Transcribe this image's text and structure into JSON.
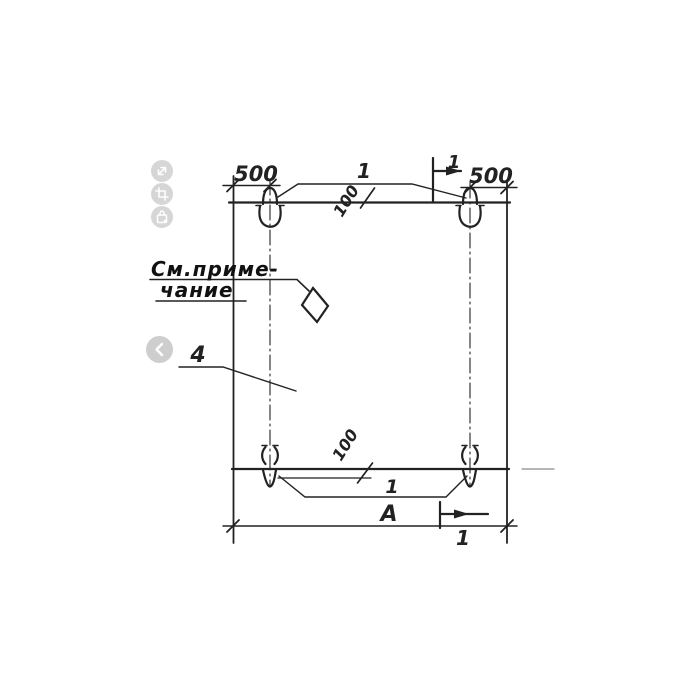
{
  "viewer": {
    "tools": [
      {
        "id": "expand",
        "icon": "expand-icon"
      },
      {
        "id": "crop",
        "icon": "crop-icon"
      },
      {
        "id": "bag",
        "icon": "bag-icon"
      }
    ],
    "nav_prev_icon": "chevron-left-icon"
  },
  "drawing": {
    "type": "technical-drawing",
    "labels": {
      "dim_top_left": "500",
      "dim_top_right": "500",
      "callout_loops_top": "1",
      "callout_loops_bottom": "1",
      "dim_offset_top": "100",
      "dim_offset_bottom": "100",
      "callout_panel": "4",
      "note_line1": "См.приме-",
      "note_line2": "чание",
      "dim_overall_width": "А",
      "section_mark_top": "1",
      "section_mark_bottom": "1"
    },
    "colors": {
      "ink": "#222222",
      "control_bg": "#c9c9c9",
      "control_glyph": "#ffffff"
    }
  }
}
